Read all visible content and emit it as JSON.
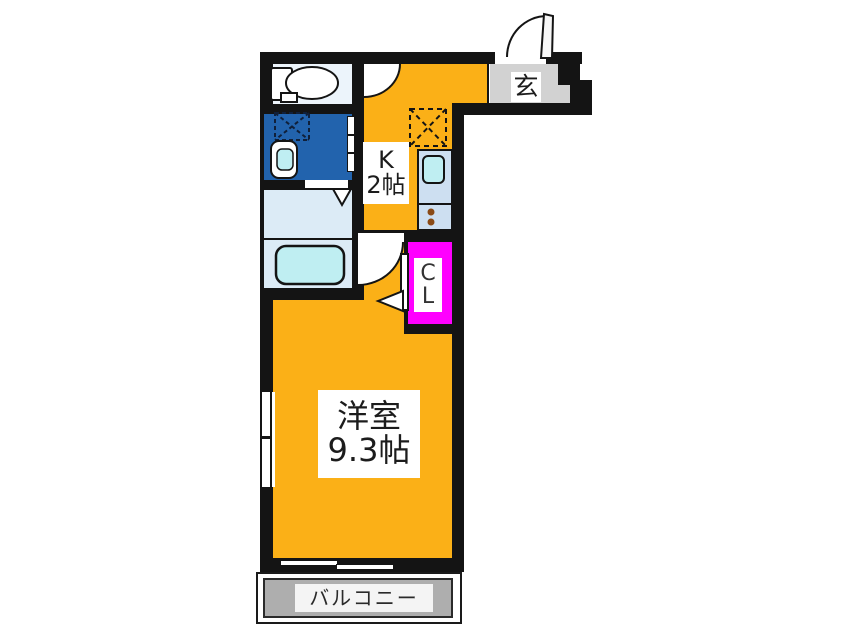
{
  "title": "1K apartment floor plan",
  "labels": {
    "entrance": "玄",
    "kitchen_type": "K",
    "kitchen_size": "2帖",
    "closet_line1": "C",
    "closet_line2": "L",
    "room_name": "洋室",
    "room_size": "9.3帖",
    "balcony": "バルコニー"
  },
  "fixture_icons": [
    "toilet-icon",
    "shower-area-icon",
    "washbasin-icon",
    "washing-machine-space-icon",
    "bathtub-icon",
    "refrigerator-space-icon",
    "kitchen-sink-icon",
    "stove-burners-icon",
    "entrance-door-swing-icon",
    "toilet-door-swing-icon",
    "room-door-swing-icon",
    "closet-door-icon",
    "closet-door-direction-triangle-icon",
    "laundry-door-triangle-icon",
    "window-icon",
    "sliding-window-icon"
  ],
  "colors": {
    "wall": "#141414",
    "room_orange": "#FBB017",
    "shower_room_blue": "#2263AD",
    "pale_blue": "#DCEBF6",
    "fixture_cyan": "#BFEEF2",
    "counter_blue": "#CDDFF1",
    "closet_magenta": "#FF00FF",
    "entrance_gray": "#D2D2D2",
    "balcony_gray": "#AEAEAE",
    "toilet_room": "#ECF4FB"
  }
}
